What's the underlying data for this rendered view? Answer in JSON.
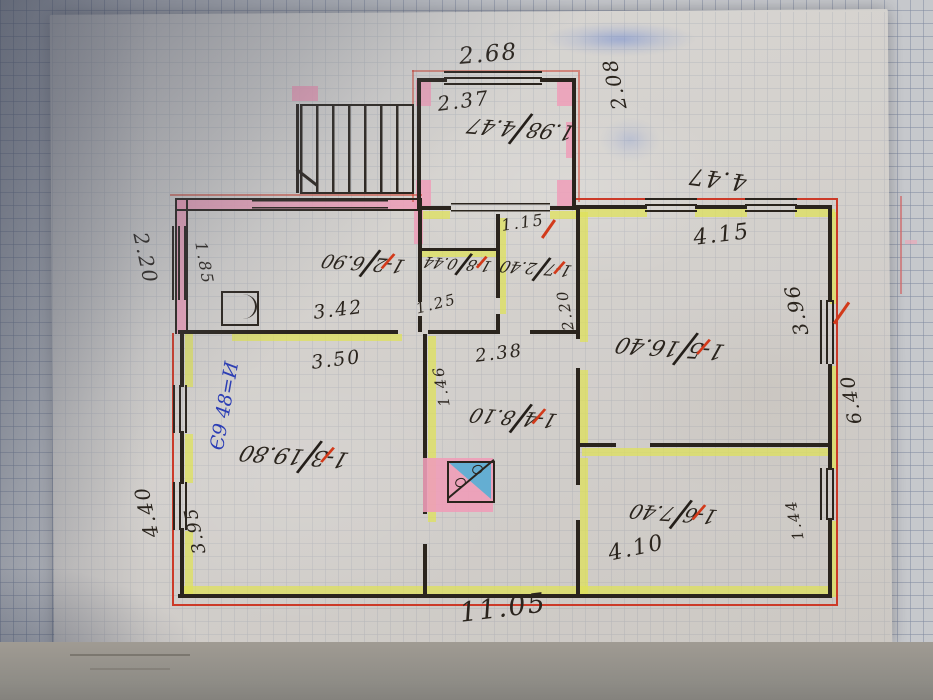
{
  "document": {
    "type": "hand-drawn BTI house floor plan on tracing paper over squared grid paper",
    "fraction_slash": "",
    "blue_note": "Є9 48=И"
  },
  "dims": {
    "d268": "2.68",
    "d237": "2.37",
    "d208": "2.08",
    "d447": "4.47",
    "d415": "4.15",
    "d396": "3.96",
    "d640": "6.40",
    "d144": "1.44",
    "d1105": "11.05",
    "d220": "2.20",
    "d185": "1.85",
    "d440": "4.40",
    "d395": "3.95",
    "d342": "3.42",
    "d350": "3.50",
    "d125": "1.25",
    "d146": "1.46",
    "d220b": "2.20",
    "d115": "1.15",
    "d238": "2.38",
    "d410": "4.10"
  },
  "annex_label": {
    "a": "1.98",
    "b": "4.47"
  },
  "rooms": [
    {
      "id": "1-2",
      "area": "6.90"
    },
    {
      "id": "1-3",
      "area": "19.80"
    },
    {
      "id": "1-4",
      "area": "8.10"
    },
    {
      "id": "1-5",
      "area": "16.40"
    },
    {
      "id": "1-6",
      "area": "7.40"
    },
    {
      "id": "1-7",
      "area": "2.40"
    },
    {
      "id": "1-8",
      "area": "0.44"
    }
  ],
  "colors": {
    "ink": "#2a241d",
    "red_boundary": "#cc3a28",
    "red_mark": "#d23a1a",
    "masonry_pink": "#ee9db8",
    "frame_yellow": "#dfe257",
    "blue_ink": "#2b3db5",
    "stove_blue": "#64aed2"
  }
}
